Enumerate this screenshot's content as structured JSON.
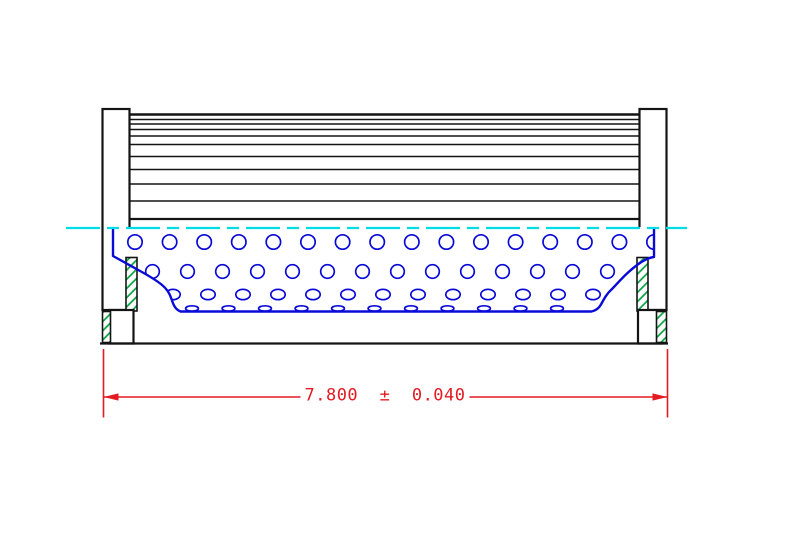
{
  "drawing": {
    "kind": "filter-element-side-section",
    "dimension": {
      "text": "7.800  ±  0.040",
      "value": "7.800",
      "tolerance": "0.040"
    }
  },
  "colors": {
    "line": "#141414",
    "core_blue": "#0a0ad8",
    "centerline_cyan": "#00dde6",
    "hatch_green": "#00a13f",
    "dimension_red": "#e31b22"
  },
  "centerline": {
    "y": 228,
    "x1": 66,
    "x2": 687,
    "dash": [
      34,
      7,
      12,
      7
    ]
  },
  "pleats": {
    "left": 129.5,
    "right": 640.5,
    "top": 114.5,
    "bottom": 219,
    "line_ys": [
      119.5,
      124,
      129.5,
      136,
      144.5,
      156.5,
      169.5,
      184,
      201
    ]
  },
  "core_holes": {
    "rows": [
      {
        "cy": 242,
        "rx": 7.2,
        "ry": 7.2,
        "x0": 135,
        "pitch": 34.6,
        "count": 16
      },
      {
        "cy": 271.5,
        "rx": 6.8,
        "ry": 6.8,
        "x0": 152.5,
        "pitch": 35,
        "count": 15
      },
      {
        "cy": 294.5,
        "rx": 7.2,
        "ry": 5.2,
        "x0": 173,
        "pitch": 35,
        "count": 13
      },
      {
        "cy": 308.5,
        "rx": 6.4,
        "ry": 2.7,
        "x0": 192,
        "pitch": 36.5,
        "count": 11
      }
    ]
  },
  "dimension_geometry": {
    "line_y": 397,
    "ext_x_left": 103.5,
    "ext_x_right": 667.5,
    "ext_y1": 349,
    "ext_y2": 417.5,
    "gap_x1": 305,
    "gap_x2": 463,
    "text_x": 385,
    "text_y": 396,
    "arrow_len": 15,
    "arrow_half_w": 3.6
  }
}
